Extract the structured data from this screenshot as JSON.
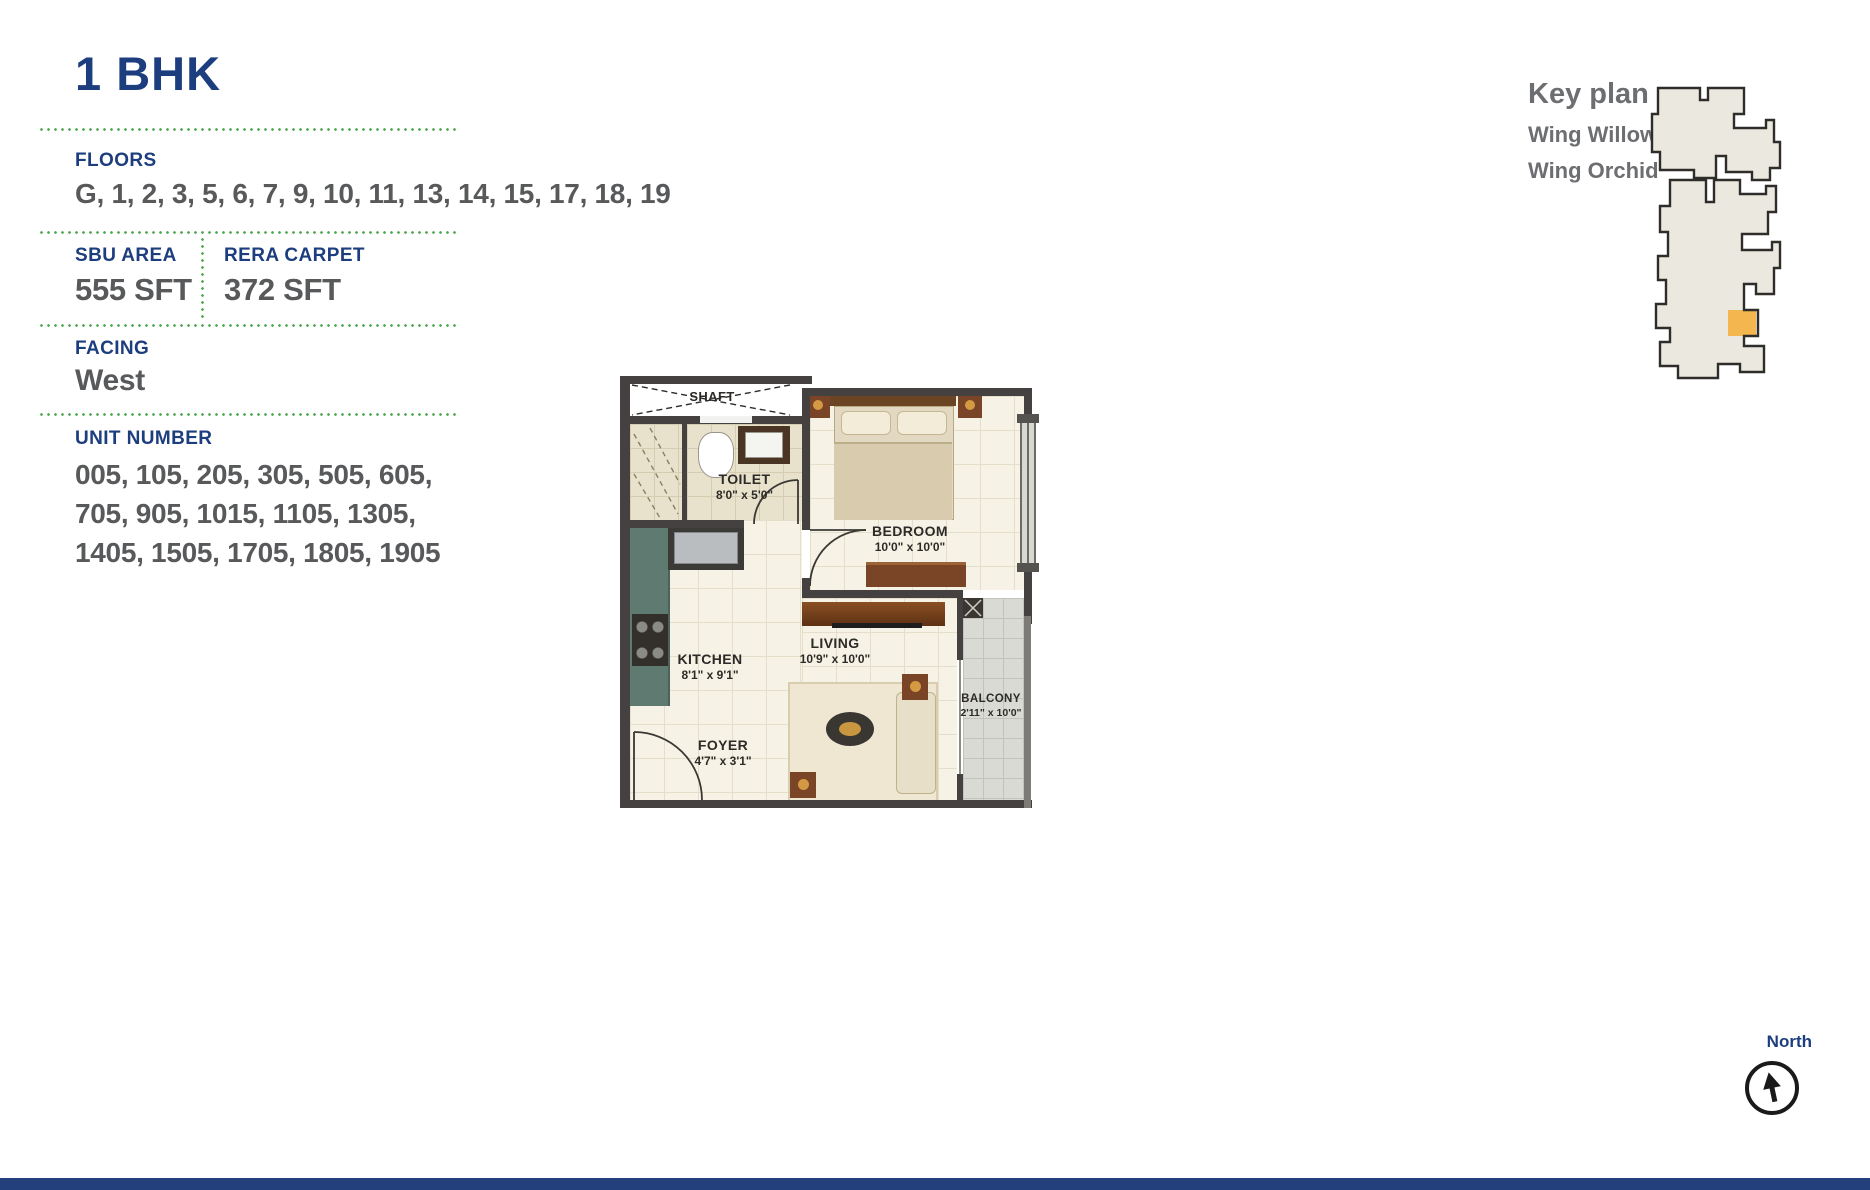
{
  "page": {
    "title": "1 BHK"
  },
  "specs": {
    "floors": {
      "label": "FLOORS",
      "value": "G, 1, 2, 3, 5, 6, 7, 9, 10, 11, 13, 14, 15, 17, 18, 19"
    },
    "sbu_area": {
      "label": "SBU AREA",
      "value": "555 SFT"
    },
    "rera_carpet": {
      "label": "RERA CARPET",
      "value": "372 SFT"
    },
    "facing": {
      "label": "FACING",
      "value": "West"
    },
    "unit_number": {
      "label": "UNIT NUMBER",
      "line1": "005, 105, 205, 305, 505, 605,",
      "line2": "705, 905, 1015, 1105, 1305,",
      "line3": "1405, 1505, 1705, 1805, 1905"
    }
  },
  "floor_plan": {
    "rooms": [
      {
        "name": "SHAFT",
        "dims": ""
      },
      {
        "name": "TOILET",
        "dims": "8'0\" x 5'0\""
      },
      {
        "name": "BEDROOM",
        "dims": "10'0\" x 10'0\""
      },
      {
        "name": "KITCHEN",
        "dims": "8'1\" x 9'1\""
      },
      {
        "name": "LIVING",
        "dims": "10'9\" x 10'0\""
      },
      {
        "name": "FOYER",
        "dims": "4'7\" x 3'1\""
      },
      {
        "name": "BALCONY",
        "dims": "2'11\" x 10'0\""
      }
    ]
  },
  "key_plan": {
    "title": "Key plan",
    "wing1": "Wing Willow",
    "wing2": "Wing Orchid",
    "highlight_color": "#f4b64e"
  },
  "compass": {
    "label": "North"
  },
  "colors": {
    "accent": "#1d3e7e",
    "text_gray": "#58595b",
    "divider_green": "#4aa64d",
    "wall": "#454140"
  }
}
